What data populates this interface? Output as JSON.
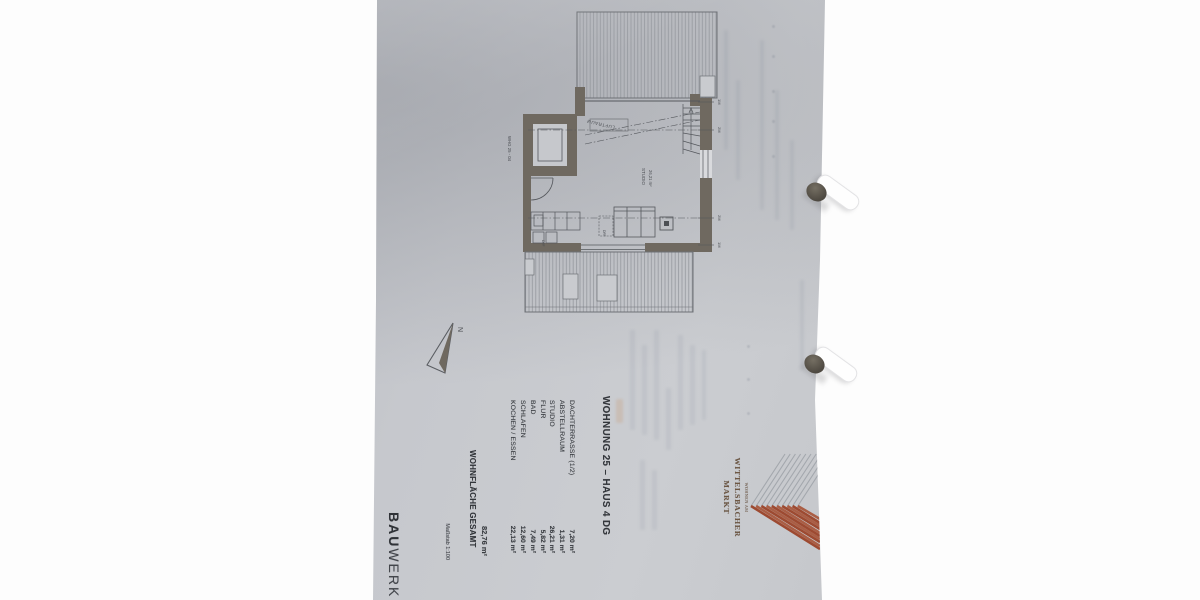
{
  "document": {
    "title": "WOHNUNG 25 – HAUS 4 DG",
    "rooms": [
      {
        "name": "KOCHEN / ESSEN",
        "area": "22,13 m²"
      },
      {
        "name": "SCHLAFEN",
        "area": "12,60 m²"
      },
      {
        "name": "BAD",
        "area": "7,49 m²"
      },
      {
        "name": "FLUR",
        "area": "5,82 m²"
      },
      {
        "name": "STUDIO",
        "area": "26,21 m²"
      },
      {
        "name": "ABSTELLRAUM",
        "area": "1,31 m²"
      },
      {
        "name": "DACHTERRASSE (1/2)",
        "area": "7,20 m²"
      }
    ],
    "total_label": "WOHNFLÄCHE GESAMT",
    "total_value": "82,76 m²",
    "scale_label": "Maßstab 1:100",
    "brand": {
      "kicker": "WOHNEN AM",
      "name_line1": "WITTELSBACHER",
      "name_line2": "MARKT",
      "stripe_brick": "#9d4a31",
      "stripe_brick_light": "#aa5e45",
      "stripe_gray": "#a3a7ad",
      "text_color": "#6e5743"
    },
    "publisher": {
      "bold": "BAU",
      "light": "WERK"
    },
    "plan": {
      "unit_label": "WHG 25 - 04",
      "void_label": "LUFTRAUM",
      "room_label": "STUDIO",
      "room_area": "26,21 m²",
      "skylight_label": "DFF",
      "north_label": "N",
      "height_marks": [
        "1M",
        "2M",
        "2M",
        "1M"
      ]
    }
  }
}
